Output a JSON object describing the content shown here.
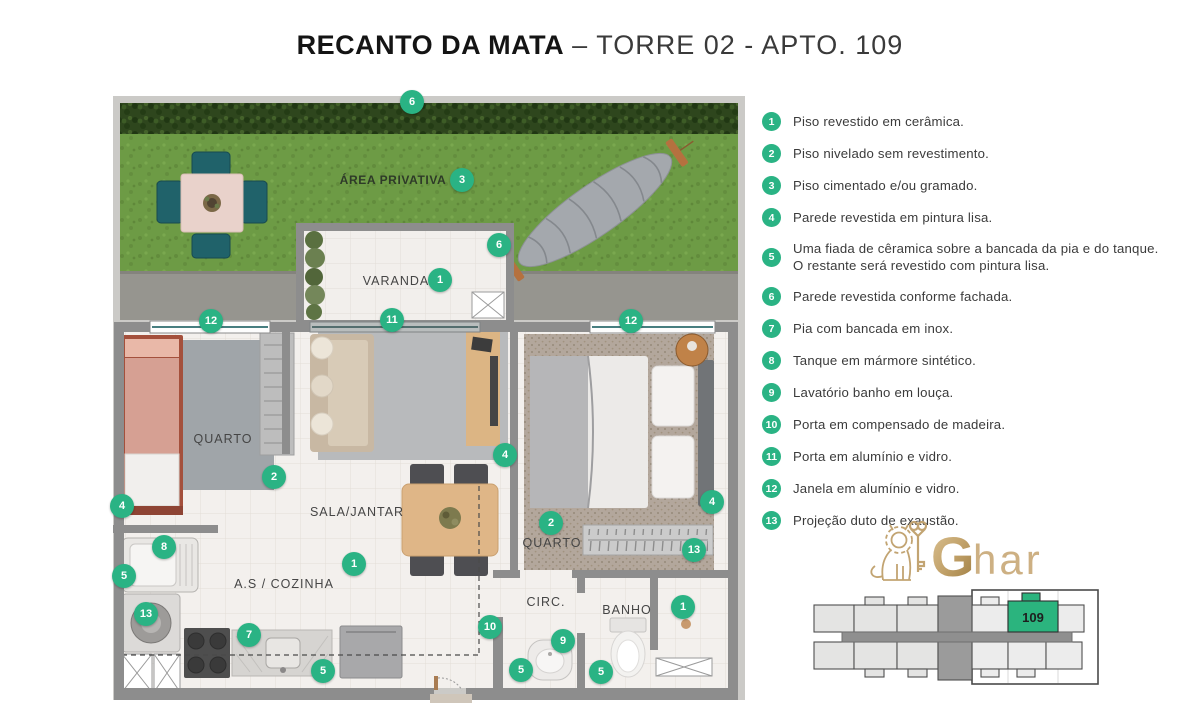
{
  "title": {
    "project": "RECANTO DA MATA",
    "unit": "– TORRE 02 - APTO. 109"
  },
  "legend": {
    "items": [
      {
        "n": "1",
        "text": "Piso revestido em cerâmica."
      },
      {
        "n": "2",
        "text": "Piso nivelado sem revestimento."
      },
      {
        "n": "3",
        "text": "Piso cimentado e/ou gramado."
      },
      {
        "n": "4",
        "text": "Parede revestida em pintura lisa."
      },
      {
        "n": "5",
        "text": "Uma fiada de cêramica sobre a bancada da pia e do tanque.\nO restante será revestido com pintura lisa."
      },
      {
        "n": "6",
        "text": "Parede revestida conforme fachada."
      },
      {
        "n": "7",
        "text": "Pia com bancada em inox."
      },
      {
        "n": "8",
        "text": "Tanque em mármore sintético."
      },
      {
        "n": "9",
        "text": "Lavatório banho em louça."
      },
      {
        "n": "10",
        "text": "Porta em compensado de madeira."
      },
      {
        "n": "11",
        "text": "Porta em alumínio e vidro."
      },
      {
        "n": "12",
        "text": "Janela em alumínio e vidro."
      },
      {
        "n": "13",
        "text": "Projeção duto de exaustão."
      }
    ]
  },
  "plan": {
    "room_labels": [
      {
        "text": "ÁREA PRIVATIVA",
        "x": 293,
        "y": 92,
        "cls": "garden"
      },
      {
        "text": "VARANDA",
        "x": 296,
        "y": 193,
        "cls": ""
      },
      {
        "text": "QUARTO",
        "x": 123,
        "y": 351,
        "cls": ""
      },
      {
        "text": "SALA/JANTAR",
        "x": 257,
        "y": 424,
        "cls": ""
      },
      {
        "text": "QUARTO",
        "x": 452,
        "y": 455,
        "cls": ""
      },
      {
        "text": "A.S / COZINHA",
        "x": 184,
        "y": 496,
        "cls": ""
      },
      {
        "text": "CIRC.",
        "x": 446,
        "y": 514,
        "cls": ""
      },
      {
        "text": "BANHO",
        "x": 527,
        "y": 522,
        "cls": ""
      }
    ],
    "markers": [
      {
        "n": "6",
        "x": 312,
        "y": 14
      },
      {
        "n": "3",
        "x": 362,
        "y": 92
      },
      {
        "n": "6",
        "x": 399,
        "y": 157
      },
      {
        "n": "1",
        "x": 340,
        "y": 192
      },
      {
        "n": "11",
        "x": 292,
        "y": 232
      },
      {
        "n": "12",
        "x": 111,
        "y": 233
      },
      {
        "n": "12",
        "x": 531,
        "y": 233
      },
      {
        "n": "2",
        "x": 174,
        "y": 389
      },
      {
        "n": "4",
        "x": 22,
        "y": 418
      },
      {
        "n": "4",
        "x": 405,
        "y": 367
      },
      {
        "n": "4",
        "x": 612,
        "y": 414
      },
      {
        "n": "2",
        "x": 451,
        "y": 435
      },
      {
        "n": "13",
        "x": 594,
        "y": 462
      },
      {
        "n": "8",
        "x": 64,
        "y": 459
      },
      {
        "n": "5",
        "x": 24,
        "y": 488
      },
      {
        "n": "13",
        "x": 46,
        "y": 526
      },
      {
        "n": "1",
        "x": 254,
        "y": 476
      },
      {
        "n": "7",
        "x": 149,
        "y": 547
      },
      {
        "n": "5",
        "x": 223,
        "y": 583
      },
      {
        "n": "10",
        "x": 390,
        "y": 539
      },
      {
        "n": "9",
        "x": 463,
        "y": 553
      },
      {
        "n": "5",
        "x": 421,
        "y": 582
      },
      {
        "n": "5",
        "x": 501,
        "y": 584
      },
      {
        "n": "1",
        "x": 583,
        "y": 519
      }
    ]
  },
  "keyplan": {
    "unit": "109"
  },
  "logo": {
    "g": "G",
    "rest": "har"
  },
  "colors": {
    "accent_green": "#2ab384",
    "keyplan_green": "#2bb47e",
    "lawn_green": "#6d9b45",
    "hedge_green": "#2e461d",
    "wall_gray": "#8d8d8d",
    "logo_gold": "#c2a472"
  }
}
